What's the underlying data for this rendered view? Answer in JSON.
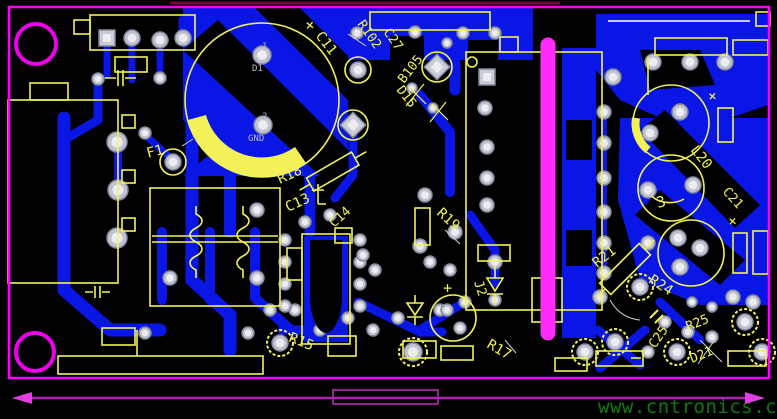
{
  "board": {
    "watermark": "www.cntronics.com",
    "refdes": {
      "f1": "F1",
      "c11": "C11",
      "r102": "R102",
      "c27": "C27",
      "b105": "B105",
      "d15": "D15",
      "r18": "R18",
      "c13": "C13",
      "c14": "C14",
      "r19": "R19",
      "j2": "J2",
      "r15": "R15",
      "r17": "R17",
      "r21": "R21",
      "r24": "R24",
      "c25": "C25",
      "r25": "R25",
      "d21": "D21",
      "l20": "L20",
      "c21": "C21"
    },
    "marks": {
      "plus": "+",
      "coil_pin": "3"
    },
    "pads": {
      "pin1": "1",
      "pin1_net": "D1",
      "pin2": "2",
      "pin2_net": "GND"
    },
    "colors": {
      "background": "#000000",
      "copper": "#0a16e6",
      "silkscreen": "#f2f258",
      "board_outline": "#ff00ff",
      "isolation_bar": "#ff2bff",
      "pad_fill": "#c9ccd6",
      "dimension": "#c02cc8",
      "watermark": "#0e7a0e"
    }
  }
}
